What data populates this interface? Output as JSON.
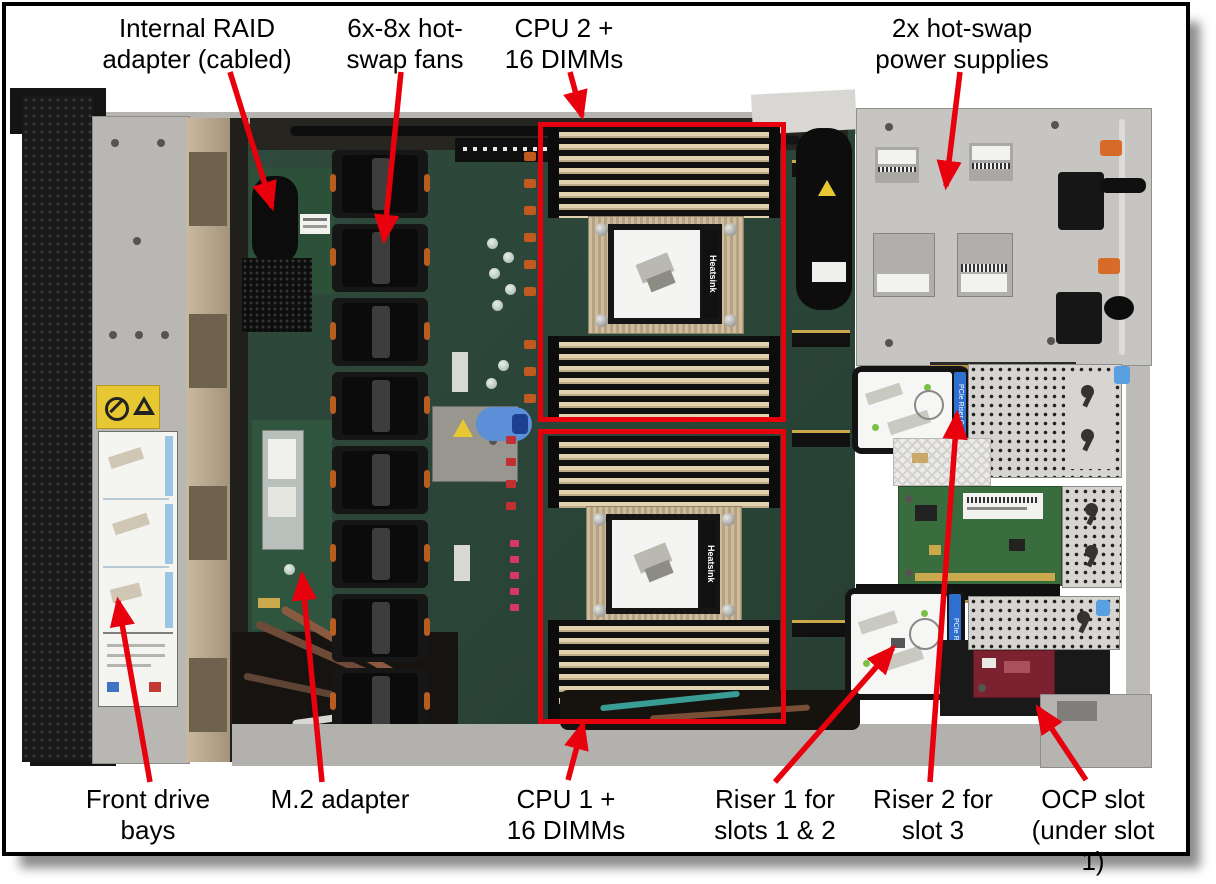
{
  "figure": {
    "description": "Server internal top view with component callouts",
    "colors": {
      "arrow": "#e8000d",
      "highlight_box": "#e8000d",
      "frame": "#000000",
      "background": "#ffffff",
      "motherboard": "#2c463a",
      "chassis_metal": "#c6c5c1"
    }
  },
  "callouts": [
    {
      "id": "internal-raid",
      "text": "Internal RAID\nadapter (cabled)"
    },
    {
      "id": "fans",
      "text": "6x-8x hot-\nswap fans"
    },
    {
      "id": "cpu2",
      "text": "CPU 2 +\n16 DIMMs"
    },
    {
      "id": "psu",
      "text": "2x hot-swap\npower supplies"
    },
    {
      "id": "front-drive",
      "text": "Front drive\nbays"
    },
    {
      "id": "m2",
      "text": "M.2 adapter"
    },
    {
      "id": "cpu1",
      "text": "CPU 1 +\n16 DIMMs"
    },
    {
      "id": "riser1",
      "text": "Riser 1 for\nslots 1 & 2"
    },
    {
      "id": "riser2",
      "text": "Riser 2 for\nslot 3"
    },
    {
      "id": "ocp",
      "text": "OCP slot\n(under slot 1)"
    }
  ],
  "micro": {
    "heatsink": "Heatsink",
    "riser_cage": "PCIe Riser Cage"
  }
}
